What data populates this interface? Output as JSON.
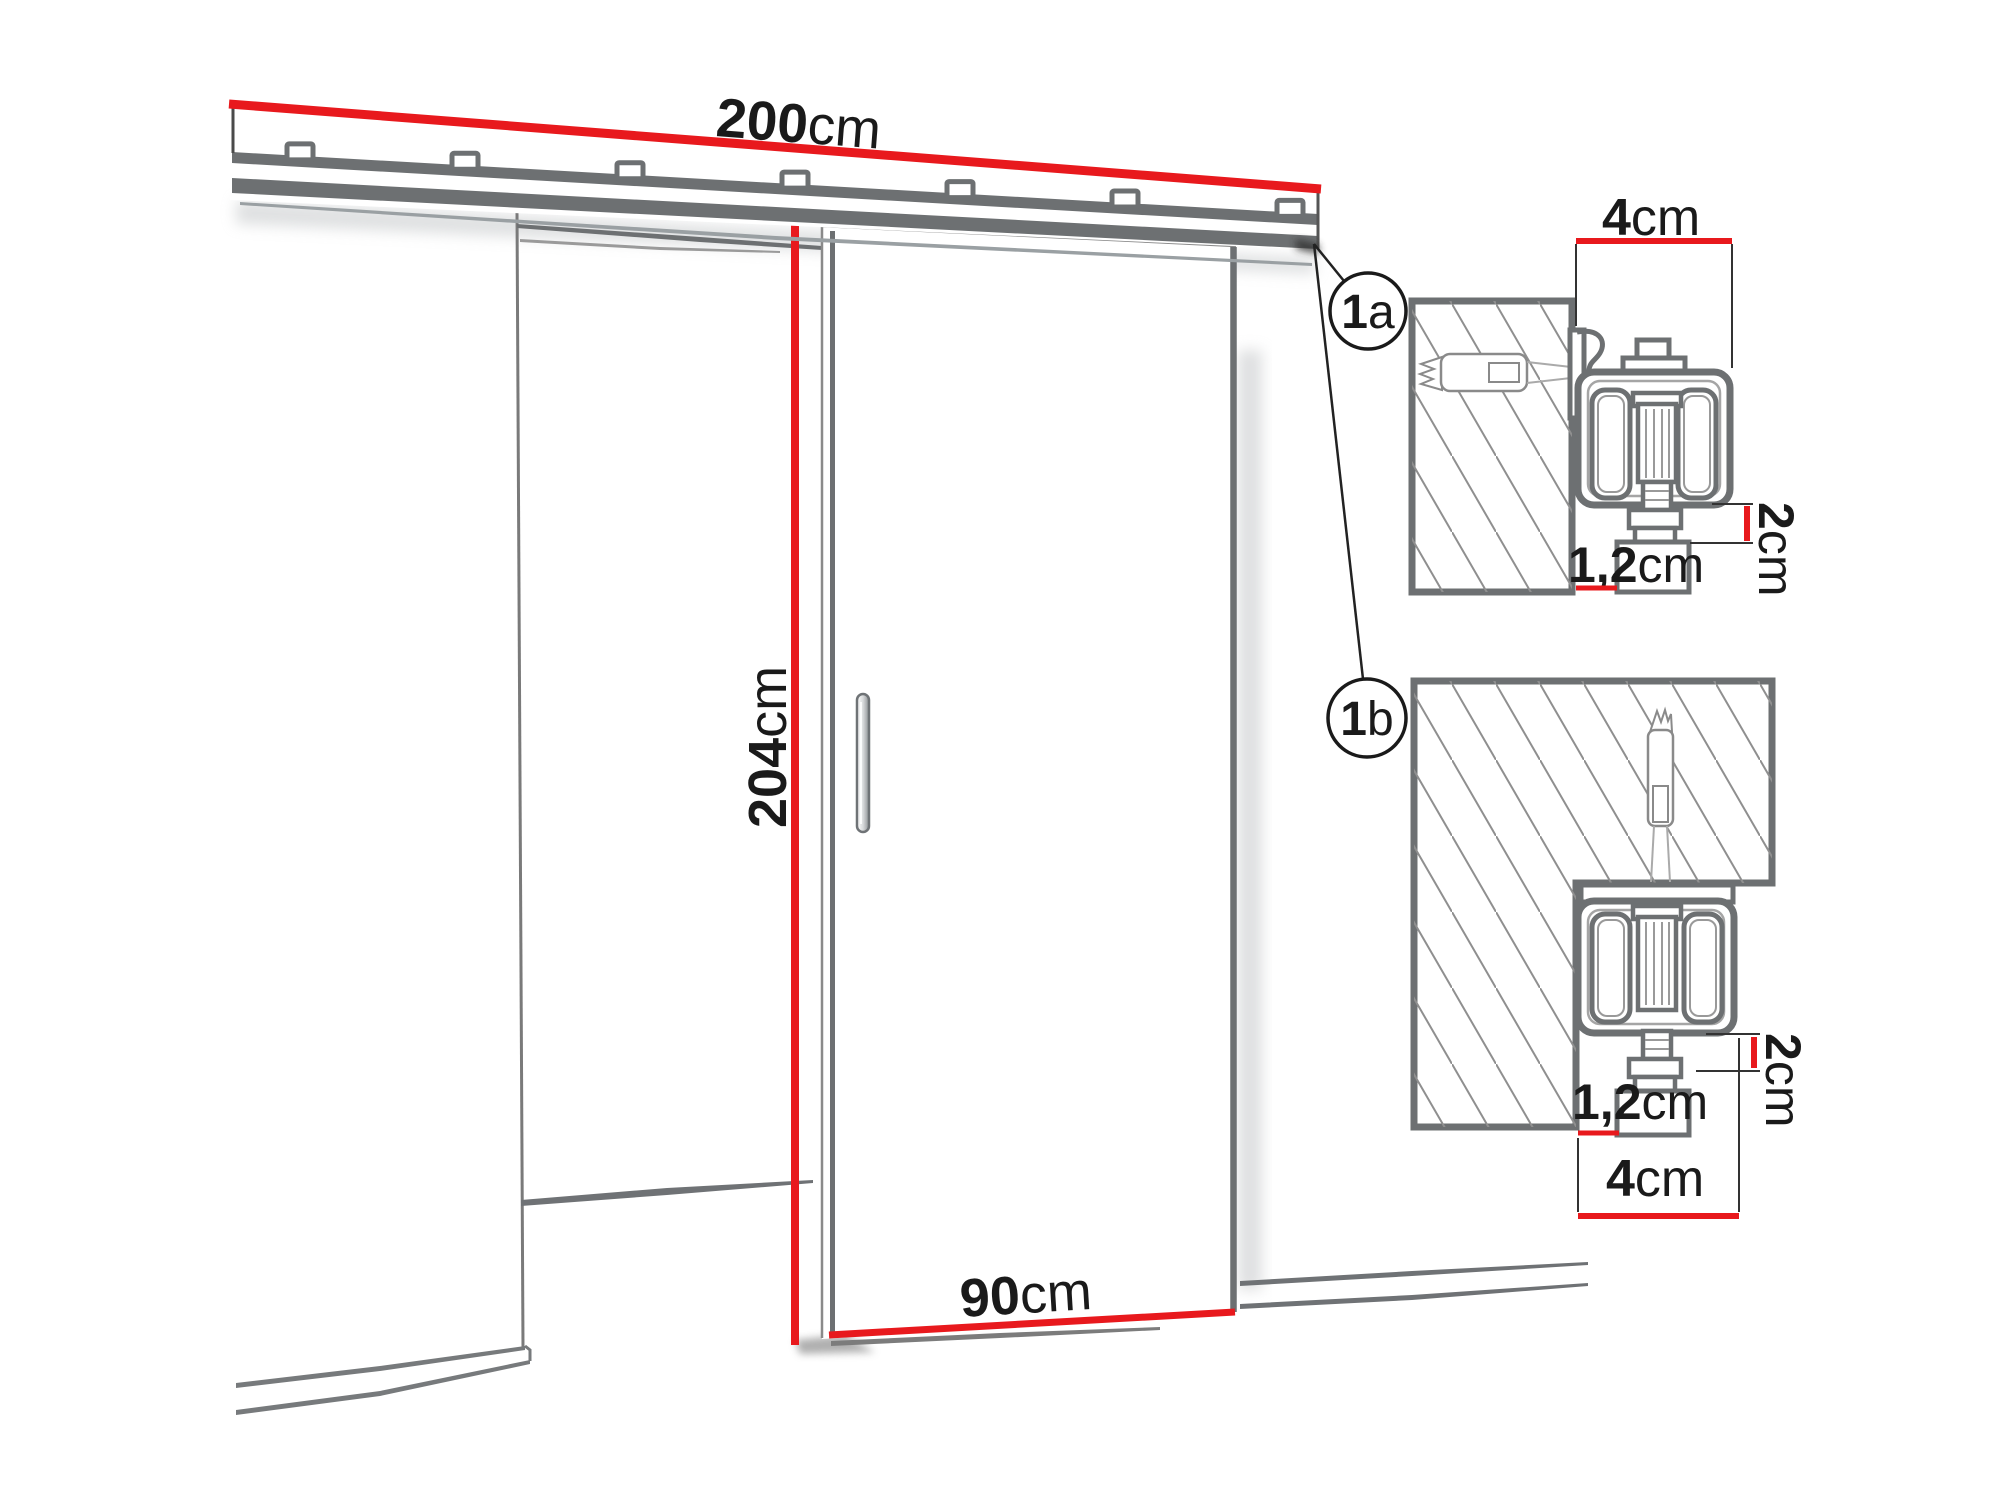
{
  "diagram": {
    "kind": "sliding-door-system-dimension-drawing",
    "colors": {
      "accent_red": "#e8191d",
      "outline_gray": "#6d7072",
      "hatch_gray": "#8f8f8f",
      "text_black": "#1a1a1a"
    },
    "main_view": {
      "rail_width_label": {
        "value": "200",
        "unit": "cm"
      },
      "door_height_label": {
        "value": "204",
        "unit": "cm"
      },
      "door_width_label": {
        "value": "90",
        "unit": "cm"
      }
    },
    "detail_a": {
      "callout_num": "1",
      "callout_suffix": "a",
      "depth_label": {
        "value": "4",
        "unit": "cm"
      },
      "drop_label": {
        "value": "2",
        "unit": "cm"
      },
      "gap_label": {
        "value": "1,2",
        "unit": "cm"
      }
    },
    "detail_b": {
      "callout_num": "1",
      "callout_suffix": "b",
      "depth_label": {
        "value": "4",
        "unit": "cm"
      },
      "drop_label": {
        "value": "2",
        "unit": "cm"
      },
      "gap_label": {
        "value": "1,2",
        "unit": "cm"
      }
    }
  }
}
